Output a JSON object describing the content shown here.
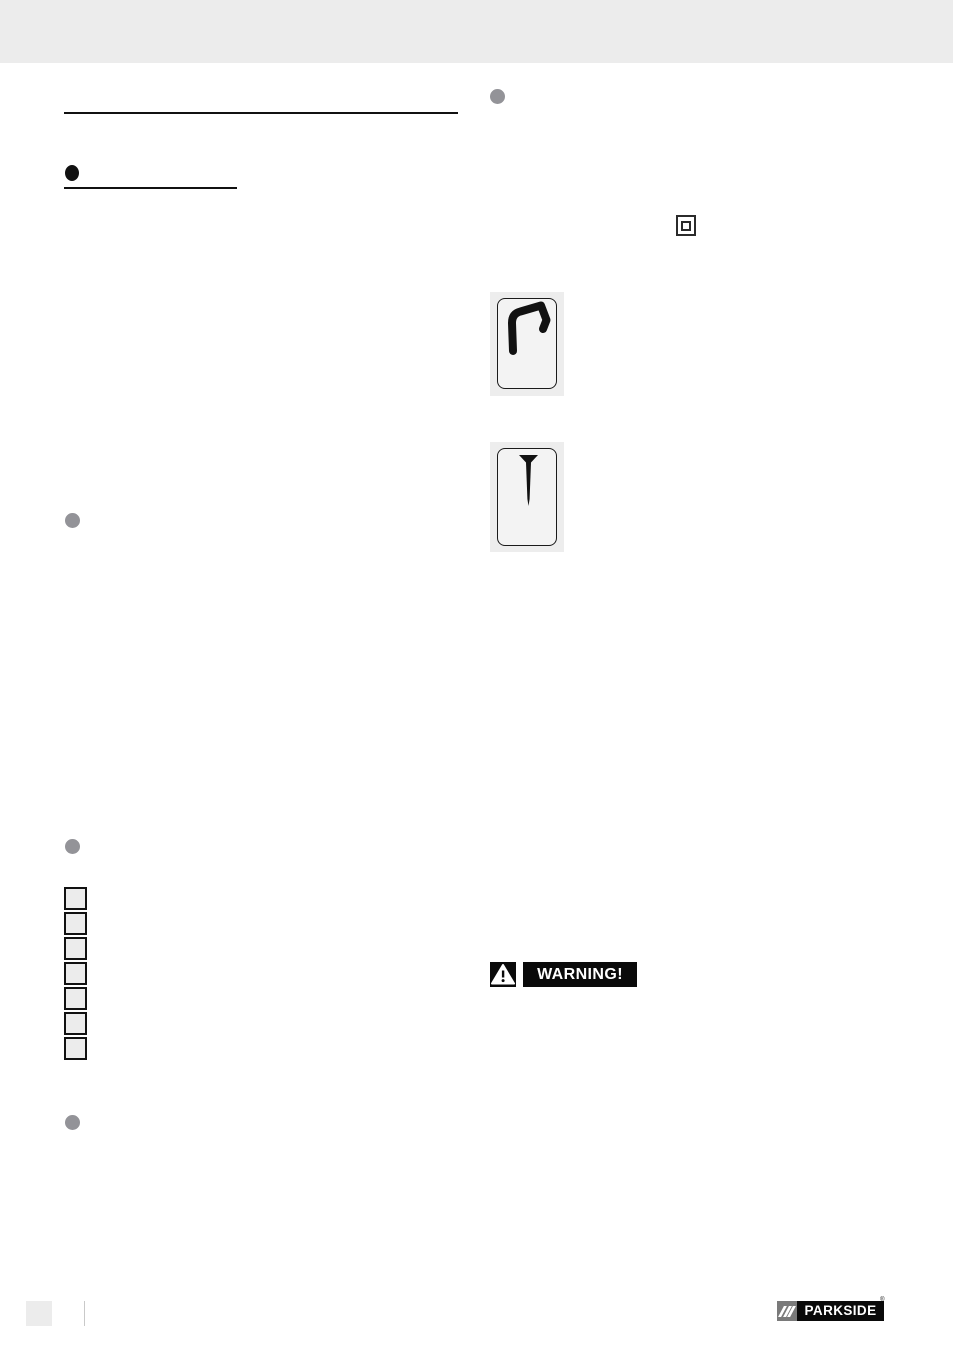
{
  "page": {
    "background": "#ffffff",
    "header_band_color": "#ececec"
  },
  "left_column": {
    "section_rule": "horizontal-divider",
    "heading_bullet_color": "#111111",
    "bullet_color": "#939398",
    "item_squares": {
      "count": 7,
      "fill": "#ececec",
      "border_color": "#111111"
    }
  },
  "right_column": {
    "bullet_color": "#939398",
    "class2_symbol": "protection-class-II-double-square",
    "figures": [
      {
        "symbol": "staple"
      },
      {
        "symbol": "nail"
      }
    ],
    "warning": {
      "label": "WARNING!",
      "icon": "warning-triangle-exclamation",
      "background": "#0a0a0a",
      "text_color": "#ffffff"
    }
  },
  "footer": {
    "page_number_box_color": "#ececec",
    "brand": {
      "slashes": "///",
      "name": "PARKSIDE",
      "registered_mark": "®",
      "slash_box_color": "#7a7a7a",
      "name_box_color": "#0a0a0a"
    }
  }
}
